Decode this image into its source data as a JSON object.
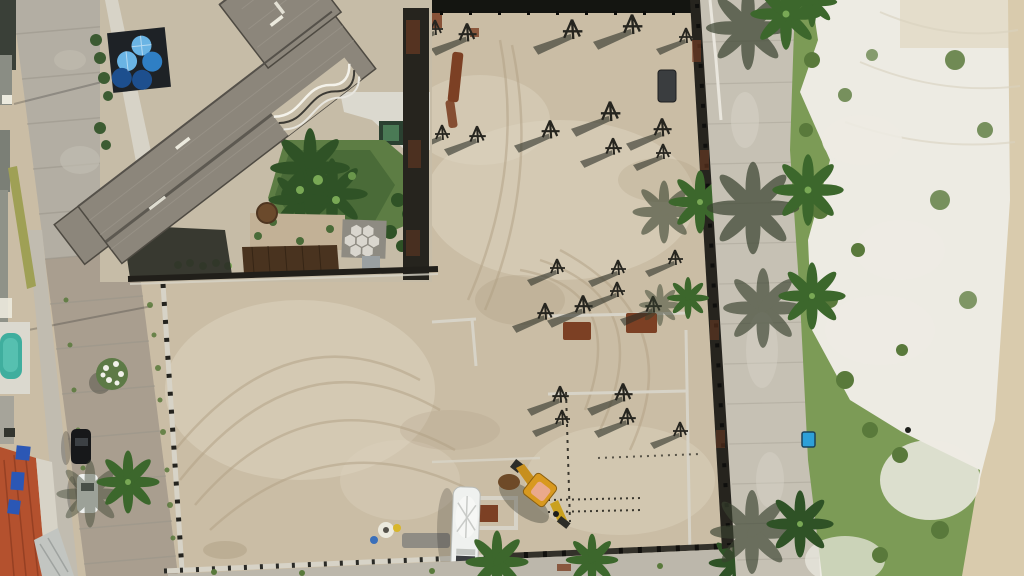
{
  "scene": {
    "type": "aerial-drone-photo",
    "subject": "beachfront construction site with cleared sandy lots, rebar column starters, excavator and cement-mixer truck, bordered by a street with buildings on the left and a palm-lined promenade, dune grass and white beach sand on the right",
    "objects": {
      "main_building": "gray flat-roof building, diagonal orientation, rooftop water tanks",
      "water_tanks": 5,
      "rebar_tripods": 24,
      "excavator": "yellow backhoe loader",
      "mixer_truck": "white cement mixer truck",
      "street_cars": [
        "black car",
        "white car"
      ],
      "swimming_pool": 1,
      "red_tile_roof_house": 1,
      "blue_bin": 1,
      "palm_trees": "several along promenade, street and site edges"
    }
  },
  "colors": {
    "street": "#b3aea3",
    "street_lower": "#a69a8a",
    "sidewalk": "#c1bcb0",
    "roof": "#8c867b",
    "roof_dark": "#55514a",
    "roof_light": "#a29c92",
    "platform": "#1e2226",
    "tank_light": "#6ab4e4",
    "tank_mid": "#2f7fc4",
    "tank_dark": "#1d4f8e",
    "garden": "#4a6b38",
    "garden_dark": "#2f5226",
    "palm": "#3c672c",
    "palm_light": "#79a855",
    "palm_shadow": "#39422f",
    "hex_bg": "#8e8b82",
    "hex_tile": "#d9d6ce",
    "brown_roof": "#49331f",
    "dirt": "#c2b196",
    "rust": "#7c4024",
    "sand": "#cabda5",
    "sand_light": "#dcd3bf",
    "sand_dark": "#a8987b",
    "track": "#b1a084",
    "fence_dark": "#211f1a",
    "wall_light": "#d7d3c7",
    "promenade": "#c6c1b4",
    "curb": "#e9e6dd",
    "grass": "#7c9b56",
    "grass_dark": "#59793b",
    "beach_white": "#edebe3",
    "beach_tan": "#d9cbad",
    "pool": "#3fae9e",
    "pool_deck": "#dbd9cf",
    "red_roof": "#b4512e",
    "red_dark": "#8e3c20",
    "tarp": "#2b57b5",
    "metal_roof": "#c2c5c1",
    "excavator": "#d8991f",
    "excavator_cab": "#eaa98c",
    "truck": "#eff1ef",
    "black_band": "#141511",
    "container": "#3a3d3f",
    "bin_blue": "#2da0d8",
    "white_mark": "#eceade",
    "moss": "#9fa055",
    "shadow": "#2b2e26",
    "property_wall": "#26241e",
    "flower": "#f1f1ea",
    "dark_roof_top": "#3a4038"
  }
}
